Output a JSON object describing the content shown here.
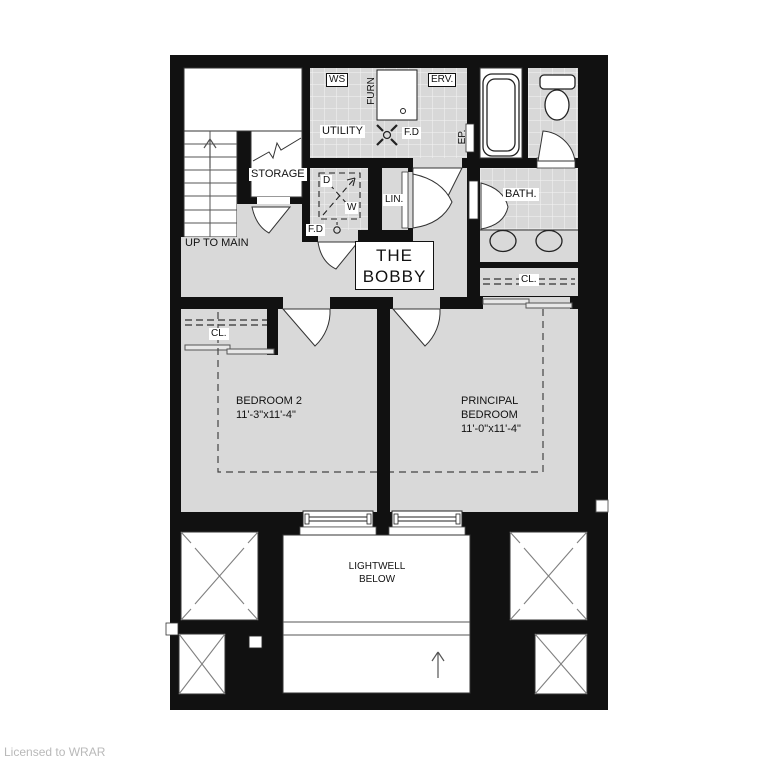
{
  "page": {
    "license_credit": "Licensed to WRAR"
  },
  "plan": {
    "title": {
      "line1": "THE",
      "line2": "BOBBY"
    },
    "stairs": {
      "label": "UP TO MAIN"
    },
    "storage": {
      "label": "STORAGE"
    },
    "utility": {
      "label": "UTILITY",
      "water_softener": "WS",
      "furnace": "FURN",
      "erv": "ERV.",
      "floor_drain": "F.D",
      "electrical_panel": "EP."
    },
    "laundry": {
      "dryer": "D",
      "washer": "W",
      "floor_drain": "F.D"
    },
    "linen": {
      "label": "LIN."
    },
    "bath": {
      "label": "BATH."
    },
    "bath_closet": {
      "label": "CL."
    },
    "bedroom2": {
      "label": "BEDROOM 2",
      "dims": "11'-3\"x11'-4\"",
      "closet": "CL."
    },
    "principal": {
      "line1": "PRINCIPAL",
      "line2": "BEDROOM",
      "dims": "11'-0\"x11'-4\""
    },
    "lightwell": {
      "line1": "LIGHTWELL",
      "line2": "BELOW"
    }
  },
  "colors": {
    "wall": "#111111",
    "floor": "#d9d9d9",
    "white": "#ffffff",
    "line": "#333333",
    "license_text": "#b9b9b9"
  }
}
